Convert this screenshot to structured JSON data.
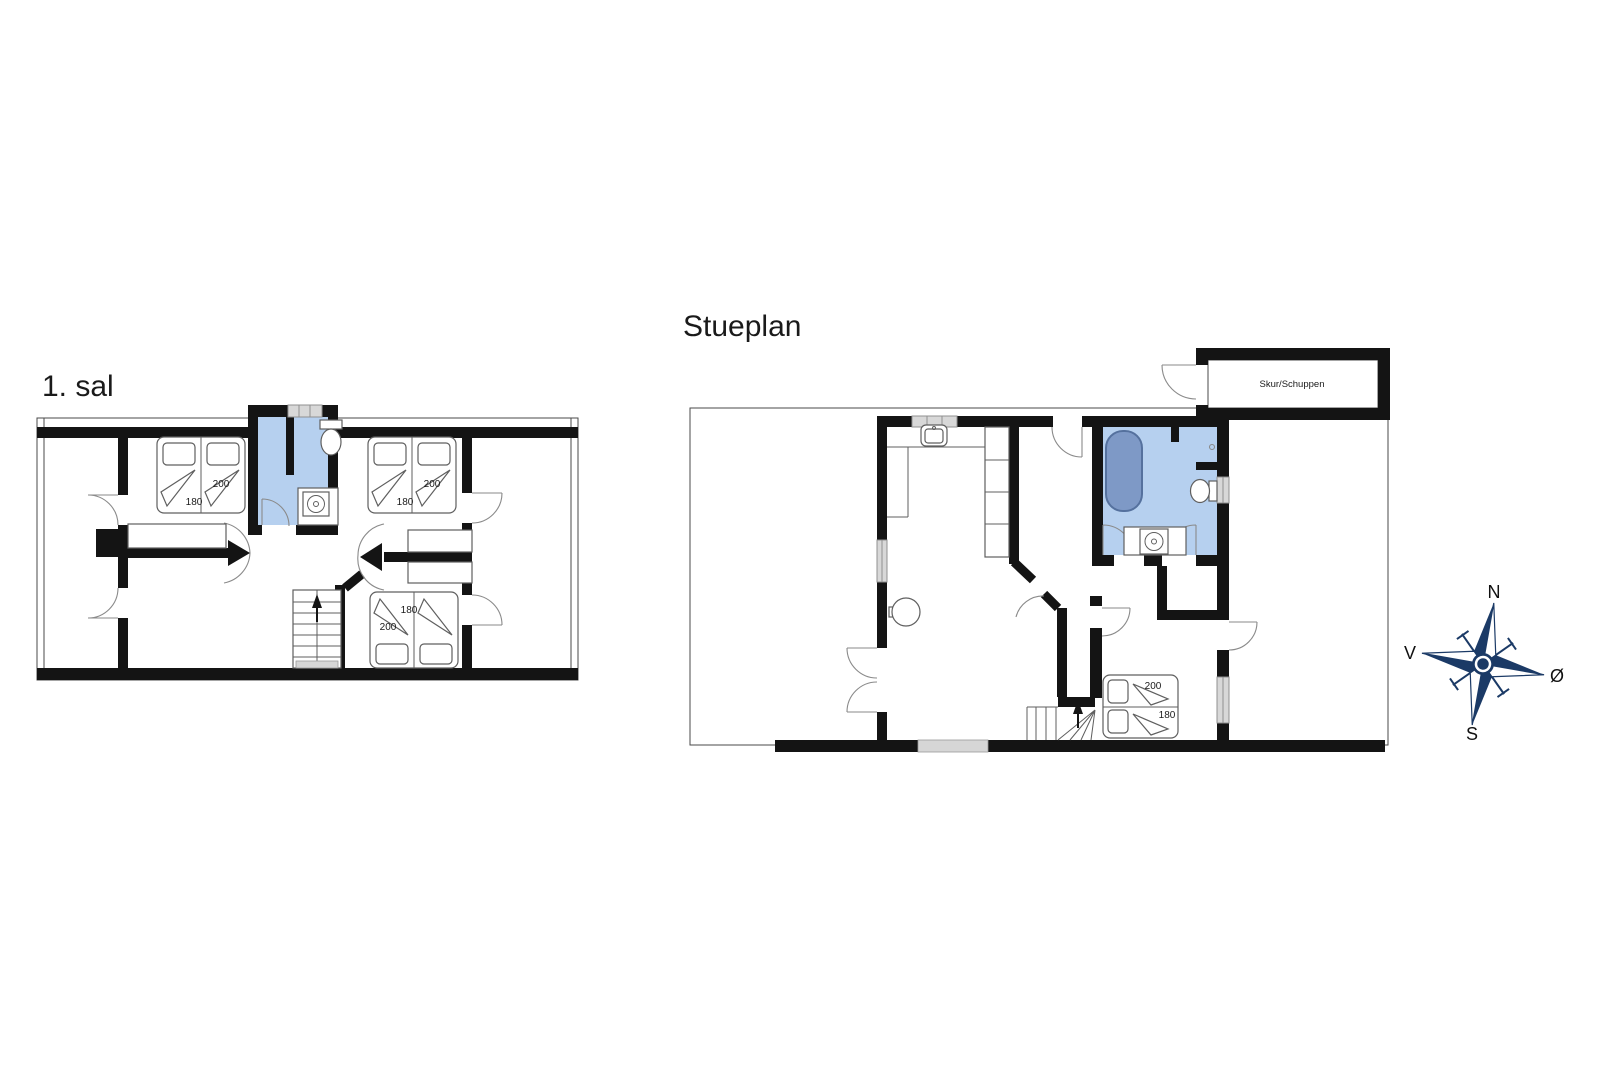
{
  "colors": {
    "wall": "#141414",
    "room_fill": "#b6d0ef",
    "tub_fill": "#7e99c6",
    "tub_stroke": "#55719e",
    "window_fill": "#d8d8d8",
    "window_stroke": "#909090",
    "furniture_stroke": "#5f5f5f",
    "arc_stroke": "#8a8a8a",
    "thin_stroke": "#4a4a4a",
    "compass": "#1b3a66",
    "text": "#1a1a1a"
  },
  "first_floor": {
    "title": "1. sal",
    "beds": [
      {
        "name": "double-bed-northwest",
        "length": "200",
        "width": "180"
      },
      {
        "name": "double-bed-northeast",
        "length": "200",
        "width": "180"
      },
      {
        "name": "double-bed-southeast",
        "length": "200",
        "width": "180"
      }
    ]
  },
  "ground_floor": {
    "title": "Stueplan",
    "shed_label": "Skur/Schuppen",
    "beds": [
      {
        "name": "double-bed-south",
        "length": "200",
        "width": "180"
      }
    ]
  },
  "compass": {
    "north": "N",
    "west": "V",
    "east": "Ø",
    "south": "S"
  }
}
